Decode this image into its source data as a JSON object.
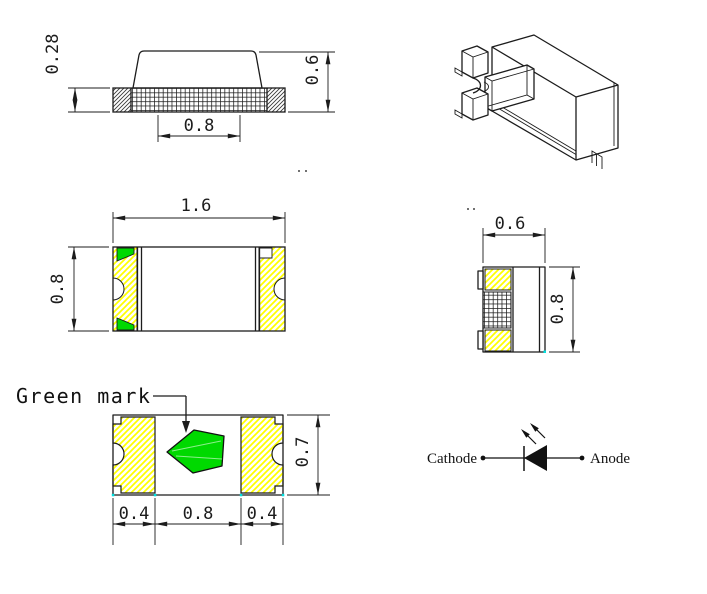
{
  "colors": {
    "terminal_hatch": "#ffff00",
    "green_mark": "#00d900",
    "line": "#1c1c1c",
    "defpoint": "#00e1e1"
  },
  "side_view": {
    "dim_substrate_thickness": "0.28",
    "dim_total_height": "0.6",
    "dim_bottom_pad": "0.8"
  },
  "top_view": {
    "dim_length": "1.6",
    "dim_width": "0.8"
  },
  "end_view": {
    "dim_width": "0.6",
    "dim_height": "0.8"
  },
  "bottom_view": {
    "green_mark_label": "Green mark",
    "dim_left_pad": "0.4",
    "dim_center_gap": "0.8",
    "dim_right_pad": "0.4",
    "dim_body_width": "0.7"
  },
  "circuit_symbol": {
    "cathode_label": "Cathode",
    "anode_label": "Anode"
  }
}
